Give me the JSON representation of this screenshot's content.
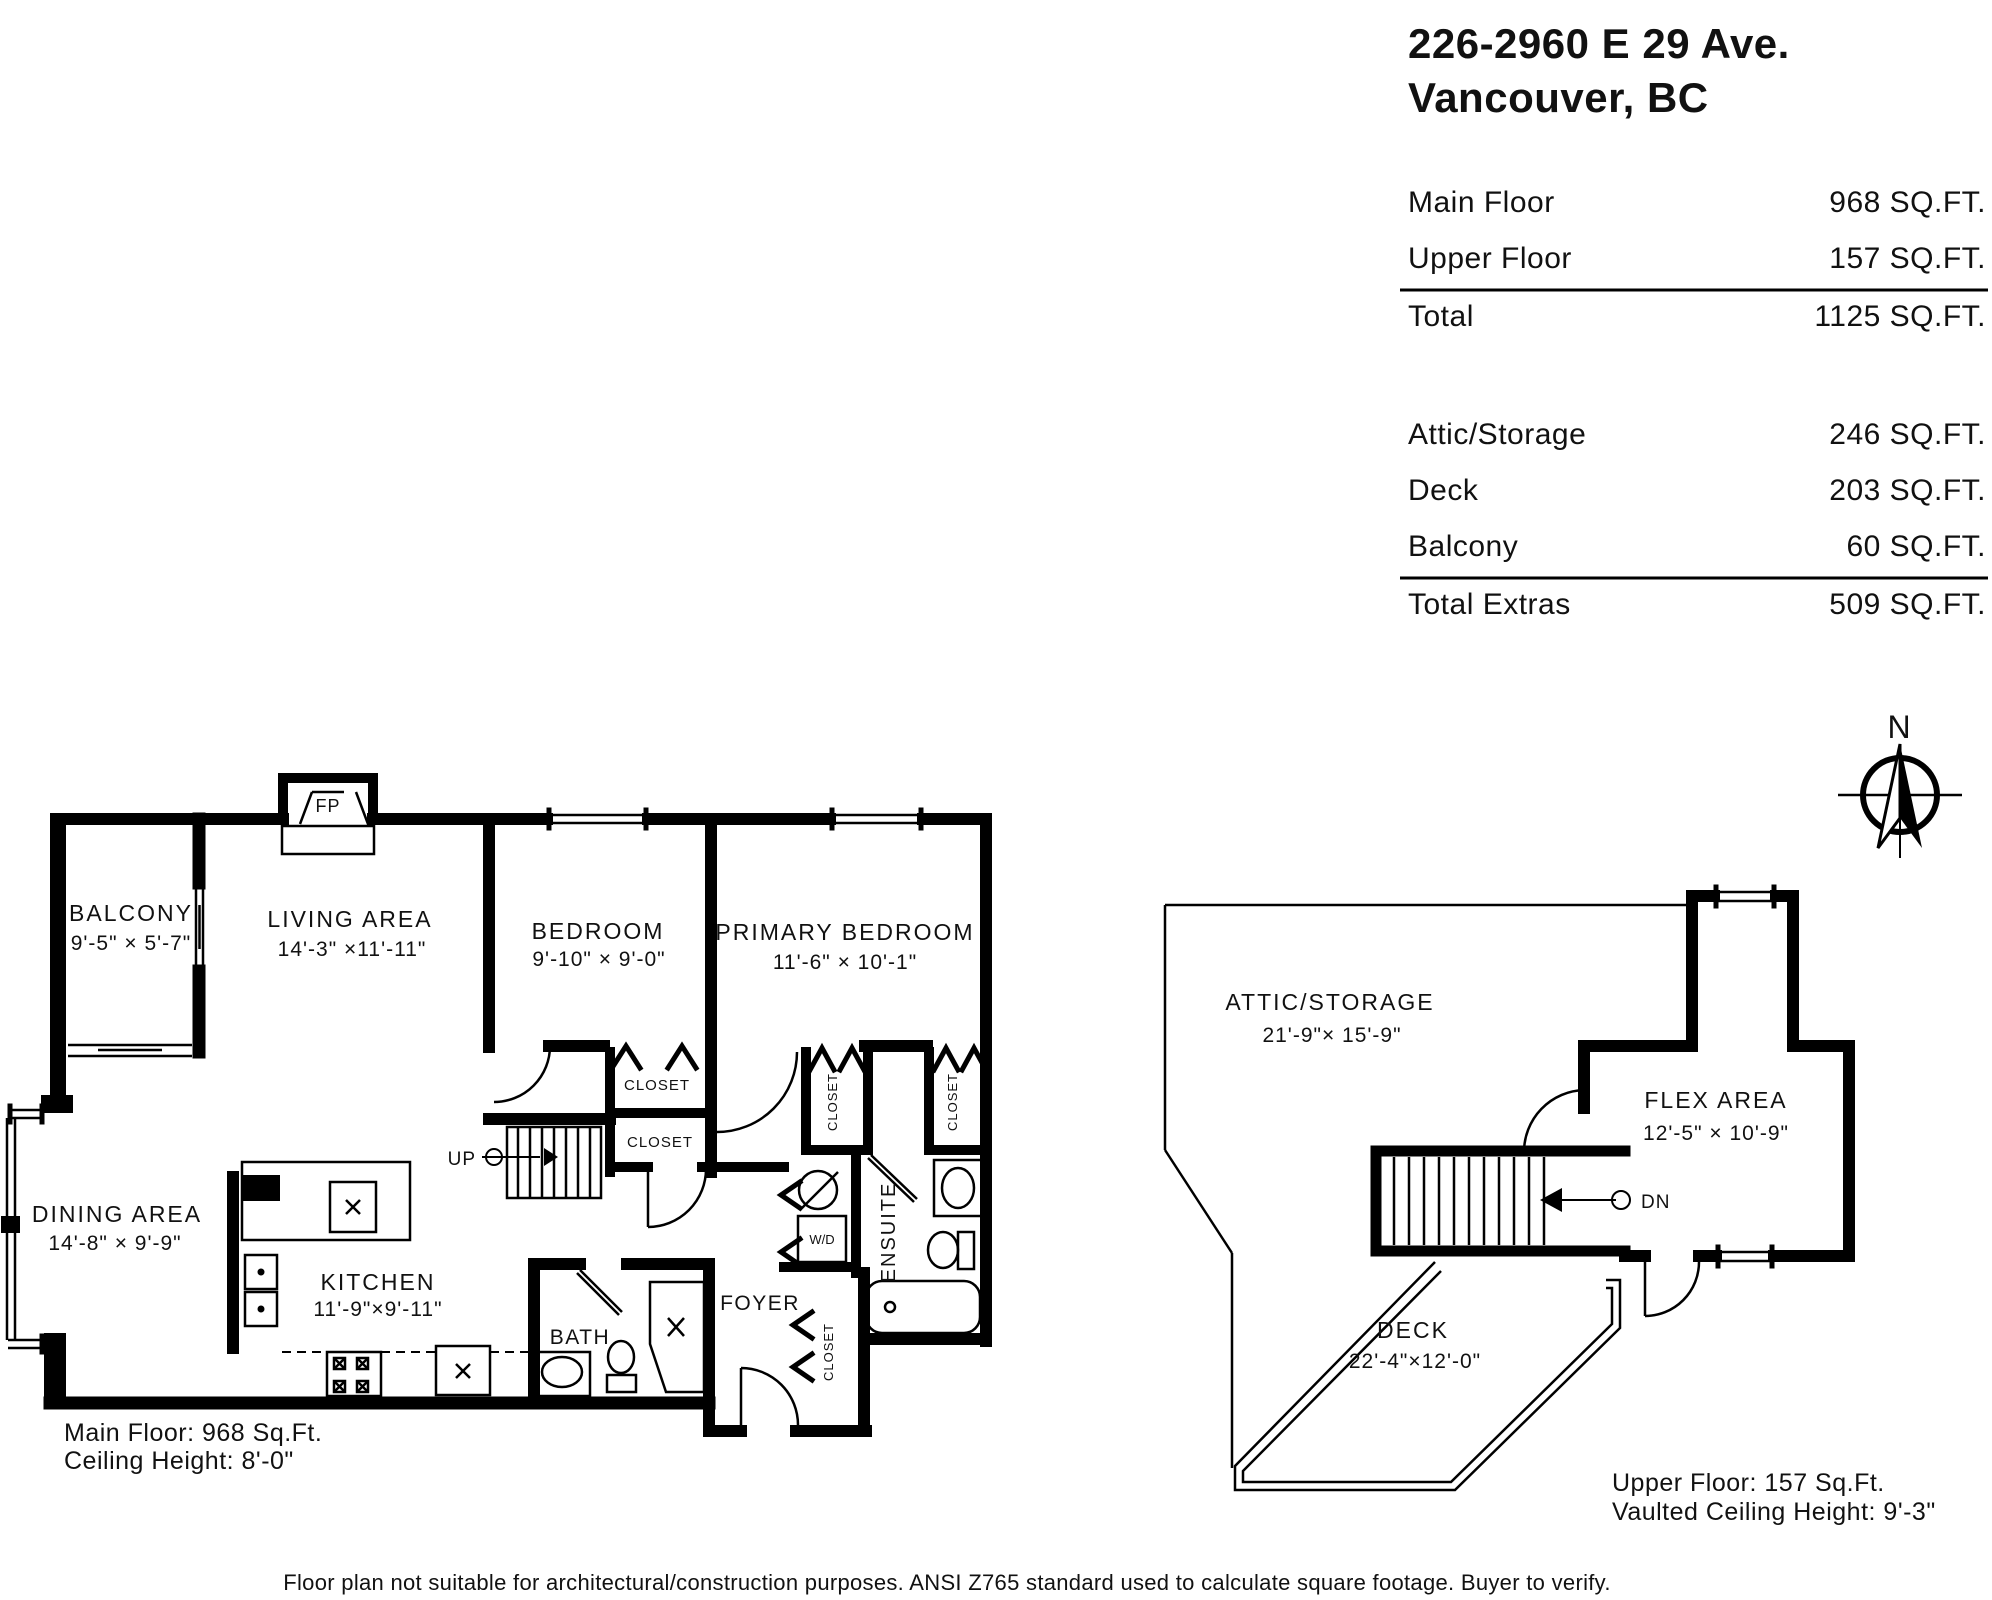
{
  "header": {
    "address_line1": "226-2960 E 29 Ave.",
    "address_line2": "Vancouver, BC",
    "table": {
      "rows": [
        {
          "label": "Main Floor",
          "value": "968 SQ.FT."
        },
        {
          "label": "Upper Floor",
          "value": "157 SQ.FT."
        },
        {
          "label": "Total",
          "value": "1125 SQ.FT."
        },
        {
          "label": "Attic/Storage",
          "value": "246 SQ.FT."
        },
        {
          "label": "Deck",
          "value": "203 SQ.FT."
        },
        {
          "label": "Balcony",
          "value": "60 SQ.FT."
        },
        {
          "label": "Total Extras",
          "value": "509 SQ.FT."
        }
      ]
    }
  },
  "compass": {
    "north_label": "N"
  },
  "main_floor": {
    "caption_line1": "Main Floor: 968 Sq.Ft.",
    "caption_line2": "Ceiling Height: 8'-0\"",
    "fireplace_label": "FP",
    "stairs_label": "UP",
    "washer_dryer_label": "W/D",
    "closet_label": "CLOSET",
    "rooms": {
      "balcony": {
        "name": "BALCONY",
        "dims": "9'-5\"  ×  5'-7\""
      },
      "living": {
        "name": "LIVING AREA",
        "dims": "14'-3\" ×11'-11\""
      },
      "bedroom": {
        "name": "BEDROOM",
        "dims": "9'-10\" × 9'-0\""
      },
      "primary": {
        "name": "PRIMARY BEDROOM",
        "dims": "11'-6\" ×  10'-1\""
      },
      "dining": {
        "name": "DINING AREA",
        "dims": "14'-8\" ×  9'-9\""
      },
      "kitchen": {
        "name": "KITCHEN",
        "dims": "11'-9\"×9'-11\""
      },
      "bath": {
        "name": "BATH"
      },
      "foyer": {
        "name": "FOYER"
      },
      "ensuite": {
        "name": "ENSUITE"
      }
    }
  },
  "upper_floor": {
    "caption_line1": "Upper Floor: 157 Sq.Ft.",
    "caption_line2": "Vaulted Ceiling Height: 9'-3\"",
    "stairs_label": "DN",
    "rooms": {
      "attic": {
        "name": "ATTIC/STORAGE",
        "dims": "21'-9\"× 15'-9\""
      },
      "flex": {
        "name": "FLEX AREA",
        "dims": "12'-5\" × 10'-9\""
      },
      "deck": {
        "name": "DECK",
        "dims": "22'-4\"×12'-0\""
      }
    }
  },
  "footer": {
    "disclaimer": "Floor plan not suitable for architectural/construction purposes. ANSI Z765 standard used to calculate square footage. Buyer to verify."
  }
}
